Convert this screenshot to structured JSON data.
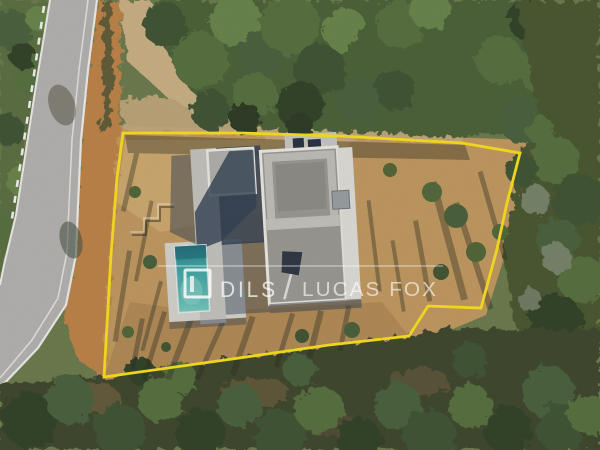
{
  "image": {
    "kind": "aerial-drone-photograph",
    "subject": "Top-down view of a modern flat-roof villa with swimming pool on a dirt plot outlined in yellow, next to a curved asphalt road surrounded by woodland"
  },
  "watermark": {
    "brand_left": "DILS",
    "separator": "/",
    "brand_right": "LUCAS FOX"
  },
  "colors": {
    "boundary_yellow": "#FFE419",
    "pool_water": "#45AFAA",
    "pool_deep": "#1F6F7E",
    "roof_gravel": "#9B9A95",
    "roof_edge_white": "#EFEEE9",
    "white_gravel": "#E2E1DC",
    "walkway_concrete": "#C6C5C0",
    "pool_deck": "#D8D6D1",
    "building_shadow": "#2E3D52",
    "road_asphalt": "#B5B5B3",
    "road_marking": "#F2F2F0",
    "dirt_plot": "#C49A60",
    "dirt_light": "#D3AE72",
    "dirt_orange": "#C08347",
    "path_tan": "#CDB286",
    "tree_green": "#55703C",
    "tree_dark": "#2F4027",
    "scrub_dark": "#3A442C",
    "tree_shadow": "#26291C"
  }
}
